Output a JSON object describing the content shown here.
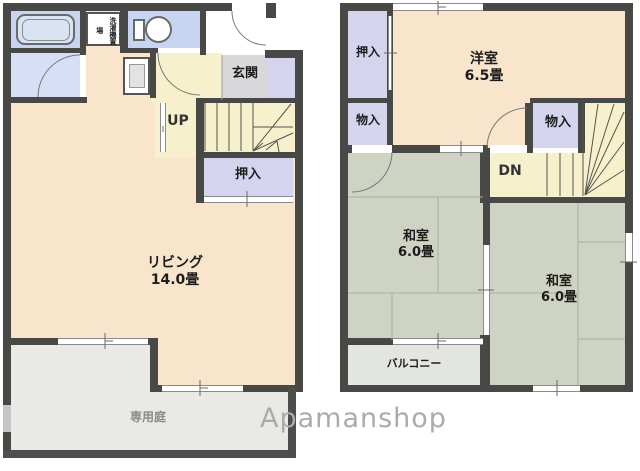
{
  "floor1": {
    "bath": {
      "laundry_label": "洗濯機置場"
    },
    "entrance_label": "玄関",
    "stairs_label": "UP",
    "closet_label": "押入",
    "living_room": {
      "name": "リビング",
      "size": "14.0畳"
    },
    "garden_label": "専用庭"
  },
  "floor2": {
    "closet_label": "押入",
    "storage_left_label": "物入",
    "storage_right_label": "物入",
    "western_room": {
      "name": "洋室",
      "size": "6.5畳"
    },
    "stairs_label": "DN",
    "tatami_room_left": {
      "name": "和室",
      "size": "6.0畳"
    },
    "tatami_room_right": {
      "name": "和室",
      "size": "6.0畳"
    },
    "balcony_label": "バルコニー"
  },
  "watermark": "Apamanshop",
  "colors": {
    "wall": "#484846",
    "room_peach": "#f8e5cc",
    "closet_lavender": "#d5d4ef",
    "bath_blue": "#c8d5f0",
    "stair_cream": "#f6f0cd",
    "tatami_green": "#ced3c3",
    "entrance_gray": "#d8d8da",
    "balcony_gray": "#e3e5e1",
    "garden_gray": "#e9e9e6"
  }
}
